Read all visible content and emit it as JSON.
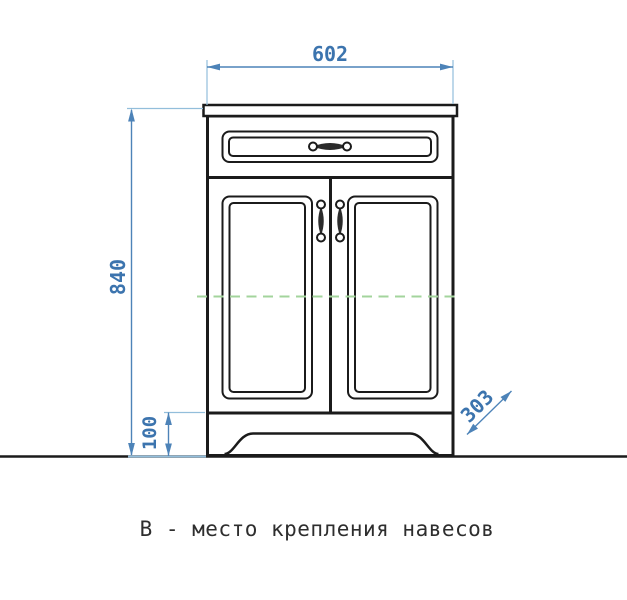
{
  "drawing": {
    "caption": "В - место крепления навесов",
    "dimensions": {
      "width_mm": "602",
      "height_mm": "840",
      "plinth_height_mm": "100",
      "depth_mm": "303"
    },
    "colors": {
      "dimension_blue": "#4d83b8",
      "extension_blue": "#93bedb",
      "text_blue": "#3c74ae",
      "mount_green": "#a3d49c",
      "line_black": "#1b1b1b"
    }
  }
}
